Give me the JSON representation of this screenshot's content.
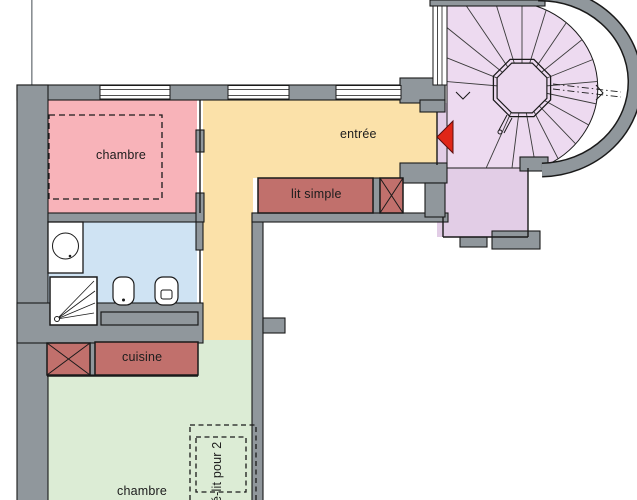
{
  "rooms": {
    "bedroom_top": {
      "label": "chambre",
      "color": "#f8b3b9"
    },
    "entry_hall": {
      "label": "entrée",
      "color": "#fbe1a9"
    },
    "bathroom": {
      "color": "#cfe3f3"
    },
    "kitchen": {
      "label": "cuisine",
      "color": "#c1706c"
    },
    "bedroom_bottom": {
      "label": "chambre",
      "color": "#dcecd5"
    },
    "stairwell": {
      "color": "#eddaf0",
      "landing_color": "#e2cde6"
    }
  },
  "furniture": {
    "single_bed": {
      "label": "lit simple",
      "color": "#c1706c"
    },
    "sofa_bed": {
      "label": "é-lit pour 2"
    },
    "storage_color": "#c1706c"
  },
  "colors": {
    "wall": "#90979c",
    "outline": "#1a1a1a",
    "door_marker": "#e02618",
    "void": "#ffffff"
  }
}
